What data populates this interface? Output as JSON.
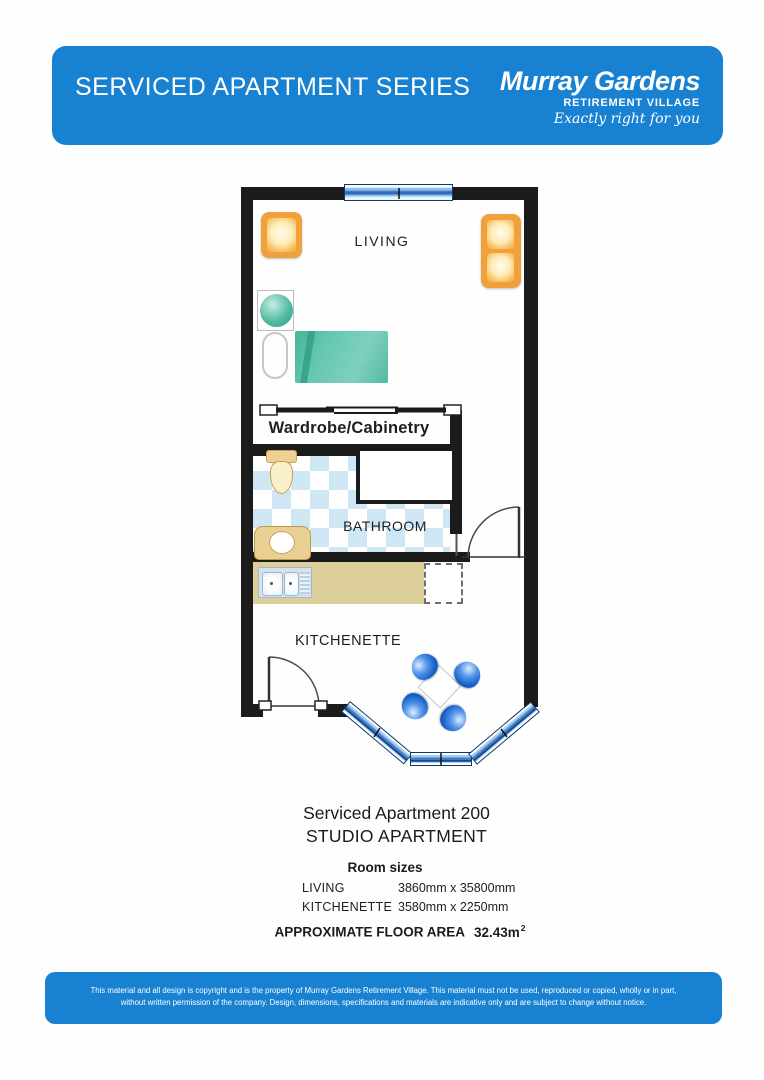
{
  "header": {
    "series_title": "SERVICED APARTMENT SERIES",
    "brand_name": "Murray Gardens",
    "brand_subtitle": "RETIREMENT VILLAGE",
    "brand_tagline": "Exactly right for you"
  },
  "plan": {
    "rooms": {
      "living": "LIVING",
      "wardrobe": "Wardrobe/Cabinetry",
      "bathroom": "BATHROOM",
      "kitchenette": "KITCHENETTE"
    }
  },
  "details": {
    "apartment_name": "Serviced Apartment 200",
    "apartment_type": "STUDIO APARTMENT",
    "room_sizes_heading": "Room sizes",
    "room_sizes": [
      {
        "room": "LIVING",
        "size": "3860mm x 35800mm"
      },
      {
        "room": "KITCHENETTE",
        "size": "3580mm x 2250mm"
      }
    ],
    "floor_area_label": "APPROXIMATE FLOOR AREA",
    "floor_area_value": "32.43m",
    "floor_area_exponent": "2"
  },
  "footer": {
    "line1": "This material and all design is copyright and is the property of Murray Gardens Retirement Village. This material must not be used, reproduced or copied, wholly or in part,",
    "line2": "without written permission of the company. Design, dimensions, specifications and materials are indicative only and are subject to change without notice."
  },
  "colors": {
    "banner_blue": "#1981d2",
    "wall_black": "#1b1b1b",
    "tile_blue": "#cfe7f5",
    "furniture_orange": "#efa13b",
    "furniture_teal": "#52bba4",
    "counter_tan": "#ddcf9a",
    "dining_chair_blue": "#1661cc",
    "window_blue": "#2d6cbe"
  }
}
